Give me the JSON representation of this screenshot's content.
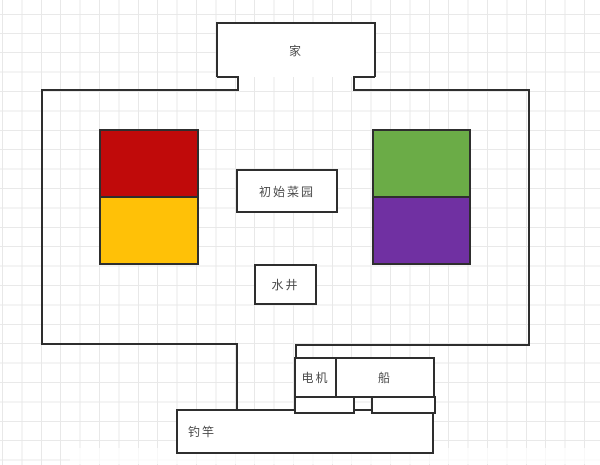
{
  "labels": {
    "home": "家",
    "garden": "初始菜园",
    "well": "水井",
    "motor": "电机",
    "boat": "船",
    "fishing_rod": "钓竿"
  },
  "blocks": {
    "red": "#c00a0a",
    "amber": "#ffc107",
    "green": "#6bac47",
    "purple": "#7030a2"
  }
}
